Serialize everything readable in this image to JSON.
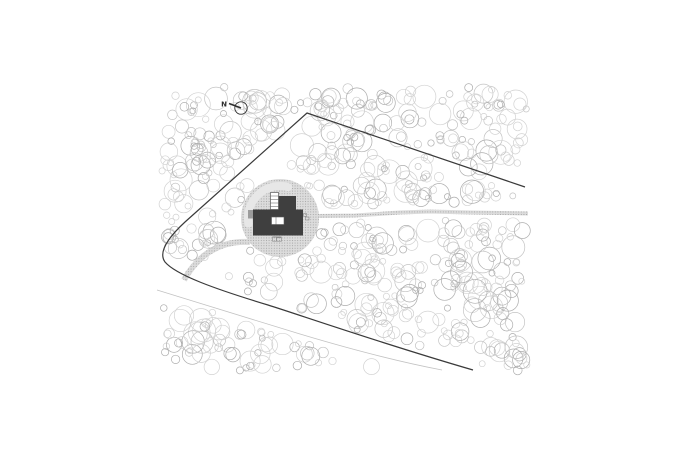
{
  "drawing": {
    "kind": "architectural-site-plan"
  },
  "north_indicator": {
    "label": "N"
  },
  "colors": {
    "background": "#ffffff",
    "tree_outline_light": "#d2d2d2",
    "tree_outline_mid": "#c3c3c3",
    "tree_outline_dark": "#adadad",
    "boundary_line": "#3a3a3a",
    "road_edge": "#c2c2c2",
    "gravel_base": "#dcdcdc",
    "gravel_dot": "#a3a3a3",
    "clearing_highlight": "#e7e7e7",
    "building_fill": "#3f3f3f",
    "building_accent": "#9c9c9c",
    "detail_stroke": "#5a5a5a",
    "fine_detail_stroke": "#8a8a8a",
    "north_stroke": "#2d2d2d",
    "white": "#ffffff"
  }
}
